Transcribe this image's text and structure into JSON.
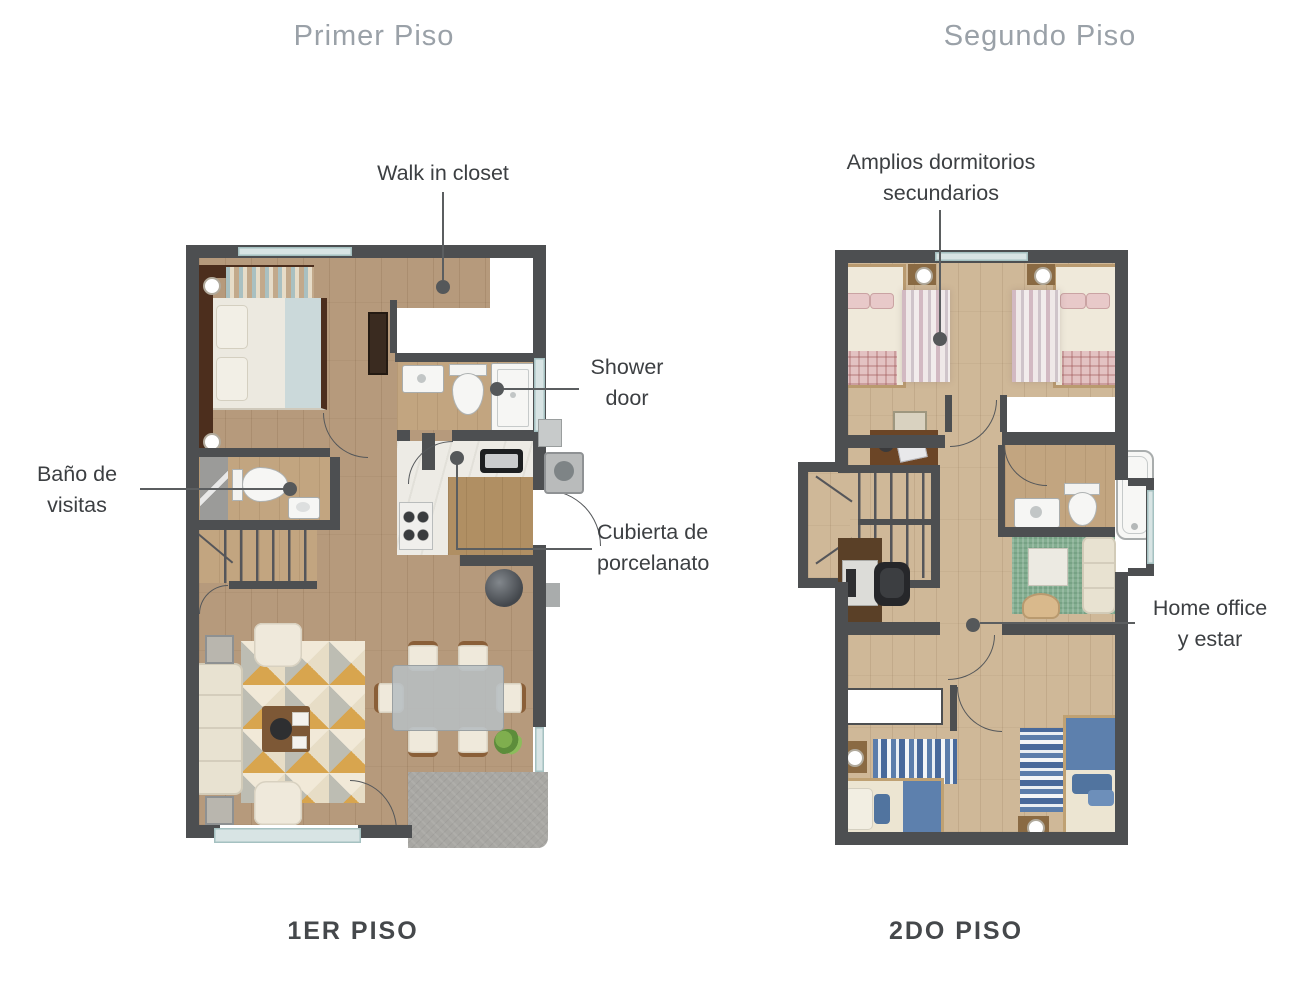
{
  "titles": {
    "first": "Primer Piso",
    "second": "Segundo Piso"
  },
  "captions": {
    "first": "1ER PISO",
    "second": "2DO PISO"
  },
  "annotations": {
    "walk_in_closet": {
      "text": "Walk in closet"
    },
    "shower_door": {
      "line1": "Shower",
      "line2": "door"
    },
    "bano_visitas": {
      "line1": "Baño de",
      "line2": "visitas"
    },
    "cubierta": {
      "line1": "Cubierta de",
      "line2": "porcelanato"
    },
    "dormitorios": {
      "line1": "Amplios dormitorios",
      "line2": "secundarios"
    },
    "home_office": {
      "line1": "Home office",
      "line2": "y estar"
    }
  },
  "colors": {
    "wall": "#4d4f51",
    "wood_floor_1": "#b69a7c",
    "wood_floor_2": "#cfb898",
    "marble": "#edebe5",
    "window": "#d8e4e4",
    "title_gray": "#9aa1a8",
    "label_dark": "#3c3f42",
    "leader_dot": "#55585a",
    "accent_orange_rug": "#d8a54e",
    "accent_blue_bedding": "#5b7dab",
    "accent_pink_rug": "#d2b9c2",
    "accent_green_rug": "#84ae91",
    "patio_stone": "#a8a7a3"
  }
}
